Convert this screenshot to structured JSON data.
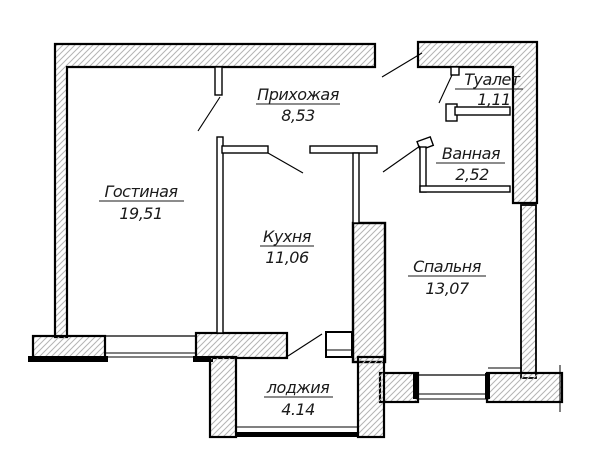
{
  "drawing": {
    "type": "apartment-floor-plan",
    "rooms": [
      {
        "id": "hallway",
        "name": "Прихожая",
        "area": "8,53"
      },
      {
        "id": "toilet",
        "name": "Туалет",
        "area": "1,11"
      },
      {
        "id": "bathroom",
        "name": "Ванная",
        "area": "2,52"
      },
      {
        "id": "living",
        "name": "Гостиная",
        "area": "19,51"
      },
      {
        "id": "kitchen",
        "name": "Кухня",
        "area": "11,06"
      },
      {
        "id": "bedroom",
        "name": "Спальня",
        "area": "13,07"
      },
      {
        "id": "loggia",
        "name": "лоджия",
        "area": "4.14"
      }
    ],
    "colors": {
      "wall_line": "#000000",
      "hatch_line": "#b4b4b4",
      "background": "#ffffff",
      "text": "#1a1a1a"
    }
  }
}
